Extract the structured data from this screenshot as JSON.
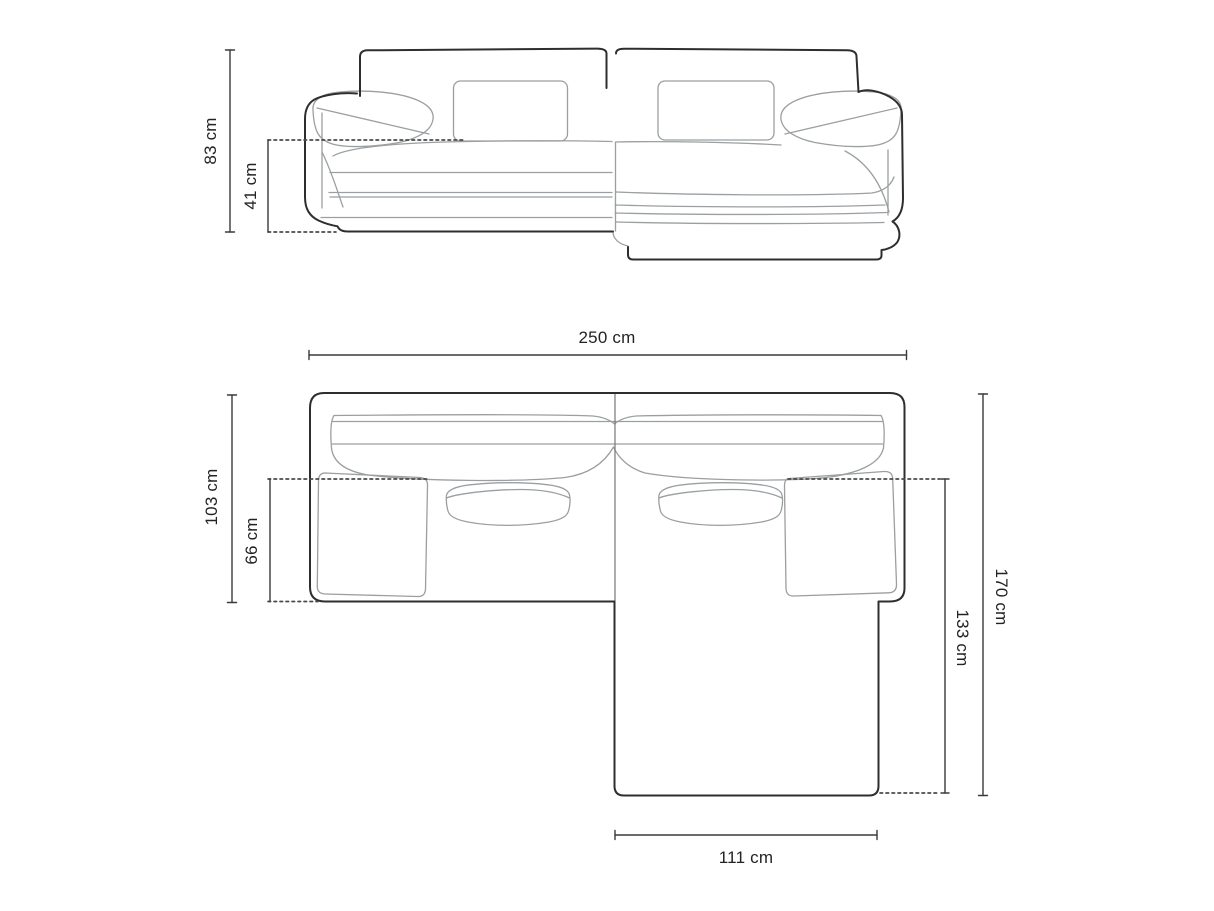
{
  "diagram": {
    "subject": "corner-sofa-technical-dimension-drawing",
    "views": [
      "front-elevation",
      "top-plan"
    ],
    "front_view": {
      "dimensions": [
        {
          "name": "overall-height",
          "label": "83 cm"
        },
        {
          "name": "seat-height",
          "label": "41 cm"
        }
      ]
    },
    "top_view": {
      "dimensions": [
        {
          "name": "overall-width",
          "label": "250 cm"
        },
        {
          "name": "body-depth",
          "label": "103 cm"
        },
        {
          "name": "seat-depth",
          "label": "66 cm"
        },
        {
          "name": "overall-depth",
          "label": "170 cm"
        },
        {
          "name": "chaise-depth",
          "label": "133 cm"
        },
        {
          "name": "chaise-width",
          "label": "111 cm"
        }
      ]
    },
    "colors": {
      "background": "#ffffff",
      "outline": "#2e2e2e",
      "seam": "#9b9fa1",
      "dimension_line": "#3a3a3a",
      "dotted_line": "#4a4a4a",
      "text": "#232323"
    }
  }
}
